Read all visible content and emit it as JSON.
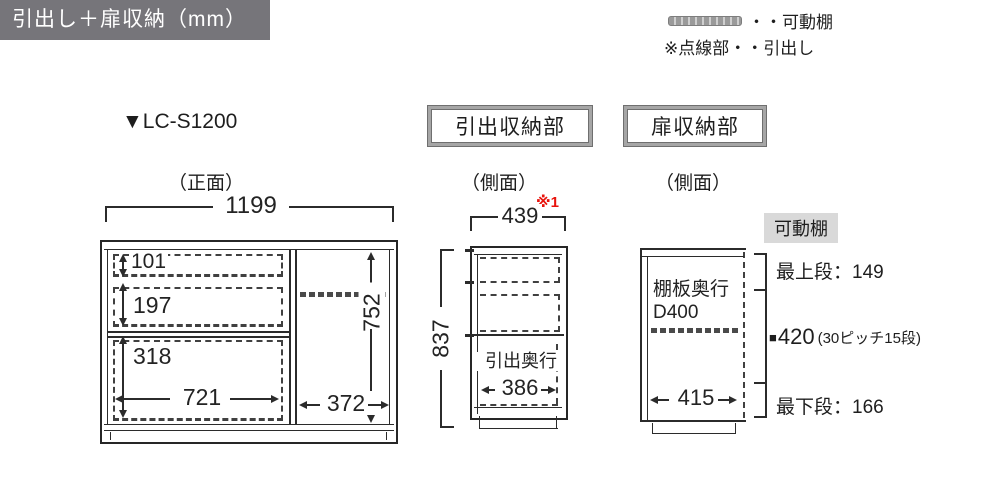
{
  "header": {
    "title": "引出し＋扉収納（mm）"
  },
  "legend": {
    "shelf_label": "・・可動棚",
    "drawer_note": "※点線部・・引出し"
  },
  "model_label": "▼LC-S1200",
  "front_view": {
    "caption": "（正面）",
    "total_width": "1199",
    "drawer1_height": "101",
    "drawer2_height": "197",
    "drawer3_height": "318",
    "drawer3_width": "721",
    "door_section_width": "372",
    "door_section_height": "752"
  },
  "drawer_side_view": {
    "title": "引出収納部",
    "caption": "（側面）",
    "footnote": "※1",
    "top_width": "439",
    "total_height": "837",
    "depth_label": "引出奥行",
    "depth_value": "386"
  },
  "door_side_view": {
    "title": "扉収納部",
    "caption": "（側面）",
    "shelf_depth_label": "棚板奥行",
    "shelf_depth_value": "D400",
    "inner_width": "415"
  },
  "movable_shelf_info": {
    "title": "可動棚",
    "top_row": "最上段：149",
    "pitch_marker": "■",
    "pitch_value": "420",
    "pitch_note": "(30ピッチ15段)",
    "bottom_row": "最下段：166"
  },
  "colors": {
    "header_bg": "#76757a",
    "accent_red": "#e8130c",
    "label_bg": "#d9d9d9",
    "line": "#2b2b2b"
  }
}
